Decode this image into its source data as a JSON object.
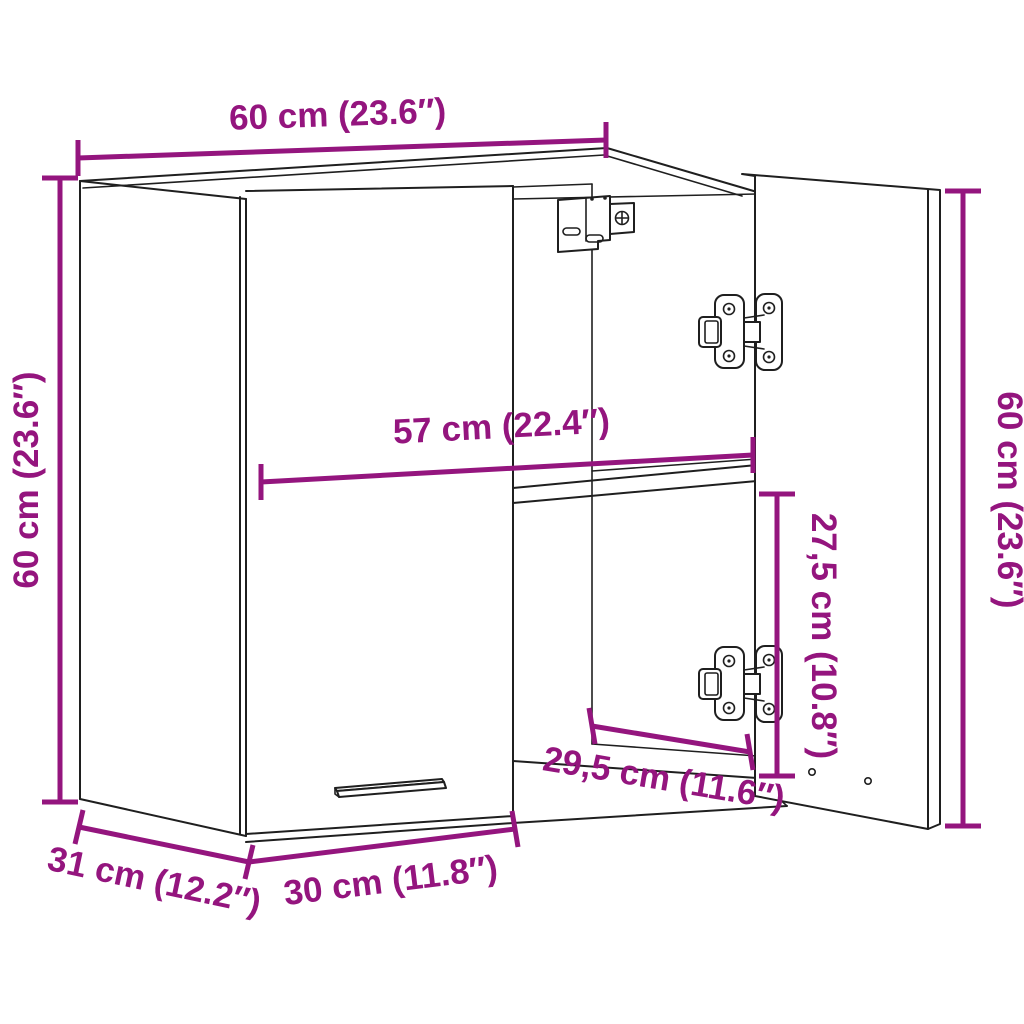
{
  "diagram": {
    "description": "Wall cabinet dimension diagram with open right door, shelf, hinges and wall-mount bracket",
    "colors": {
      "dimension_accent": "#94157E",
      "outline": "#1f1f1f",
      "background": "#ffffff"
    },
    "dimensions": {
      "width_top": "60 cm (23.6″)",
      "height_left": "60 cm (23.6″)",
      "height_right": "60 cm (23.6″)",
      "interior_width": "57 cm (22.4″)",
      "interior_height_below_shelf": "27,5 cm (10.8″)",
      "interior_depth": "29,5 cm (11.6″)",
      "side_depth": "31 cm (12.2″)",
      "door_width": "30 cm (11.8″)"
    }
  }
}
